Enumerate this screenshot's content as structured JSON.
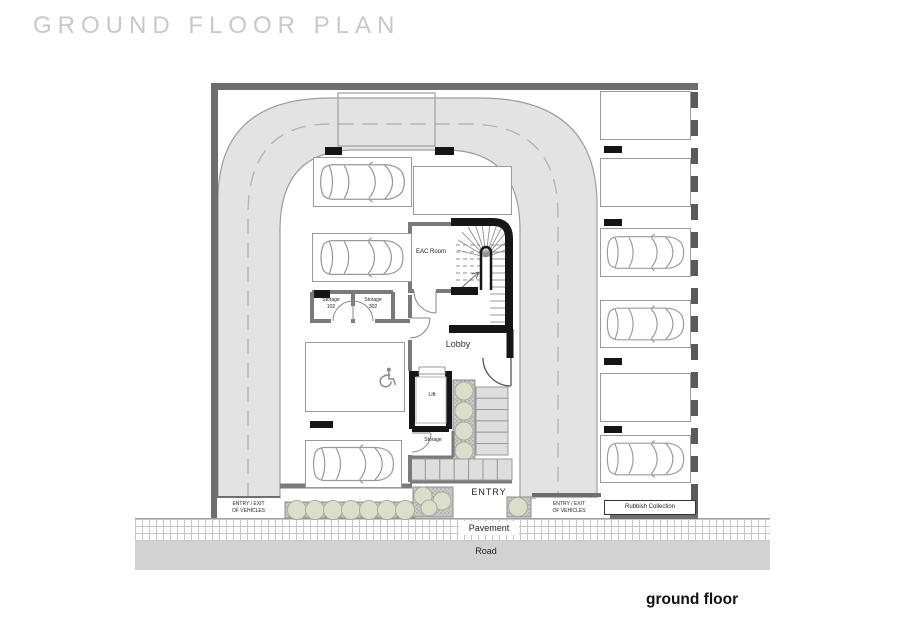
{
  "title": "GROUND FLOOR PLAN",
  "caption": "ground floor",
  "rooms": {
    "eac_room": "EAC Room",
    "lobby": "Lobby",
    "lift": "Lift",
    "storage_small": "Storage",
    "storage_left": "Storage\n102",
    "storage_right": "Storage\n302",
    "rubbish": "Rubbish Collection"
  },
  "site": {
    "entry": "ENTRY",
    "vehicle_entry_left": "ENTRY / EXIT\nOF VEHICLES",
    "vehicle_entry_right": "ENTRY / EXIT\nOF VEHICLES",
    "pavement": "Pavement",
    "road": "Road"
  },
  "parking": {
    "inner_spaces": [
      {
        "id": "inner-1",
        "car": true,
        "accessible": false
      },
      {
        "id": "inner-2",
        "car": false,
        "accessible": false
      },
      {
        "id": "inner-3",
        "car": true,
        "accessible": false
      },
      {
        "id": "inner-4",
        "car": false,
        "accessible": true
      },
      {
        "id": "inner-5",
        "car": true,
        "accessible": false
      }
    ],
    "right_spaces": [
      {
        "id": "right-1",
        "car": false
      },
      {
        "id": "right-2",
        "car": false
      },
      {
        "id": "right-3",
        "car": true
      },
      {
        "id": "right-4",
        "car": true
      },
      {
        "id": "right-5",
        "car": false
      },
      {
        "id": "right-6",
        "car": true
      }
    ]
  },
  "colors": {
    "driveway": "#e3e3e3",
    "boundary_wall": "#6e6e6e",
    "black_wall": "#161616",
    "road": "#d2d2d2",
    "step": "#dedede",
    "bush_fill": "#dbdeca",
    "title_text": "#c9c9c9"
  }
}
